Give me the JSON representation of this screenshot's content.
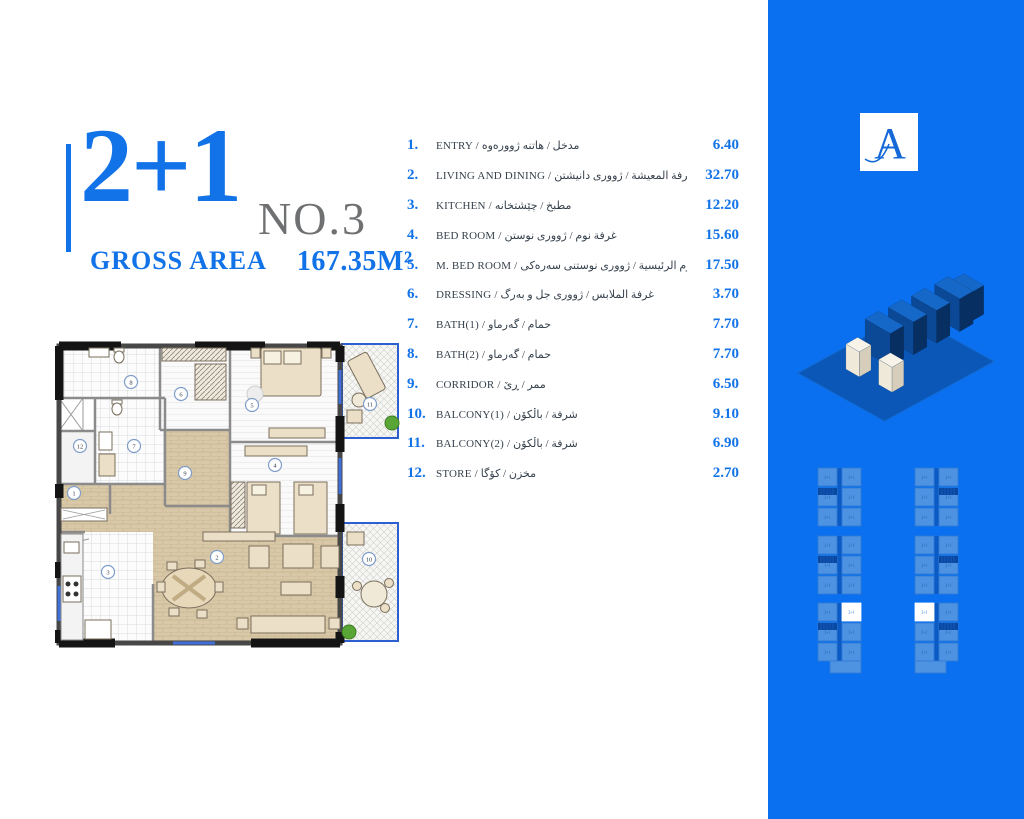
{
  "colors": {
    "accent_blue": "#1273E8",
    "sidebar_blue": "#0B70EF",
    "text_dark": "#36414C",
    "no_gray": "#6E7072"
  },
  "title": {
    "number": "2+1",
    "unit_no": "NO.3",
    "gross_area_label": "GROSS AREA",
    "gross_area_value": "167.35M²"
  },
  "rooms": [
    {
      "num": "1.",
      "label": "ENTRY / مدخل / هاتنە ژوورەوە",
      "area": "6.40"
    },
    {
      "num": "2.",
      "label": "LIVING AND DINING / غرفة المعيشة / ژوورى دانيشتن",
      "area": "32.70"
    },
    {
      "num": "3.",
      "label": "KITCHEN / مطبخ / چێشتخانە",
      "area": "12.20"
    },
    {
      "num": "4.",
      "label": "BED ROOM / غرفة نوم / ژوورى نوستن",
      "area": "15.60"
    },
    {
      "num": "5.",
      "label": "M. BED ROOM / غرفة نوم الرئيسية / ژوورى نوستنى سەرەكى",
      "area": "17.50"
    },
    {
      "num": "6.",
      "label": "DRESSING / غرفة الملابس / ژوورى جل و بەرگ",
      "area": "3.70"
    },
    {
      "num": "7.",
      "label": "BATH(1) / حمام / گەرماو",
      "area": "7.70"
    },
    {
      "num": "8.",
      "label": "BATH(2) / حمام / گەرماو",
      "area": "7.70"
    },
    {
      "num": "9.",
      "label": "CORRIDOR / ممر / ڕێ",
      "area": "6.50"
    },
    {
      "num": "10.",
      "label": "BALCONY(1) / شرفة / باڵكۆن",
      "area": "9.10"
    },
    {
      "num": "11.",
      "label": "BALCONY(2) / شرفة / باڵكۆن",
      "area": "6.90"
    },
    {
      "num": "12.",
      "label": "STORE / مخزن / كۆگا",
      "area": "2.70"
    }
  ],
  "sidebar": {
    "logo_letter": "A",
    "key_plan": {
      "unit_label": "2+1",
      "blocks": [
        {
          "x": 5,
          "y": 10,
          "h": 60,
          "mirror": false,
          "highlight": false
        },
        {
          "x": 102,
          "y": 10,
          "h": 60,
          "mirror": true,
          "highlight": false
        },
        {
          "x": 5,
          "y": 78,
          "h": 60,
          "mirror": false,
          "highlight": false
        },
        {
          "x": 102,
          "y": 78,
          "h": 60,
          "mirror": true,
          "highlight": false
        },
        {
          "x": 5,
          "y": 145,
          "h": 67,
          "mirror": false,
          "highlight": true
        },
        {
          "x": 102,
          "y": 145,
          "h": 67,
          "mirror": true,
          "highlight": true
        }
      ]
    }
  },
  "floor_plan": {
    "markers": [
      {
        "n": "1",
        "x": 19,
        "y": 157
      },
      {
        "n": "2",
        "x": 162,
        "y": 221
      },
      {
        "n": "3",
        "x": 53,
        "y": 236
      },
      {
        "n": "4",
        "x": 220,
        "y": 129
      },
      {
        "n": "5",
        "x": 197,
        "y": 69
      },
      {
        "n": "6",
        "x": 126,
        "y": 58
      },
      {
        "n": "7",
        "x": 79,
        "y": 110
      },
      {
        "n": "8",
        "x": 76,
        "y": 46
      },
      {
        "n": "9",
        "x": 130,
        "y": 137
      },
      {
        "n": "10",
        "x": 314,
        "y": 223
      },
      {
        "n": "11",
        "x": 315,
        "y": 68
      },
      {
        "n": "12",
        "x": 25,
        "y": 110
      }
    ]
  }
}
